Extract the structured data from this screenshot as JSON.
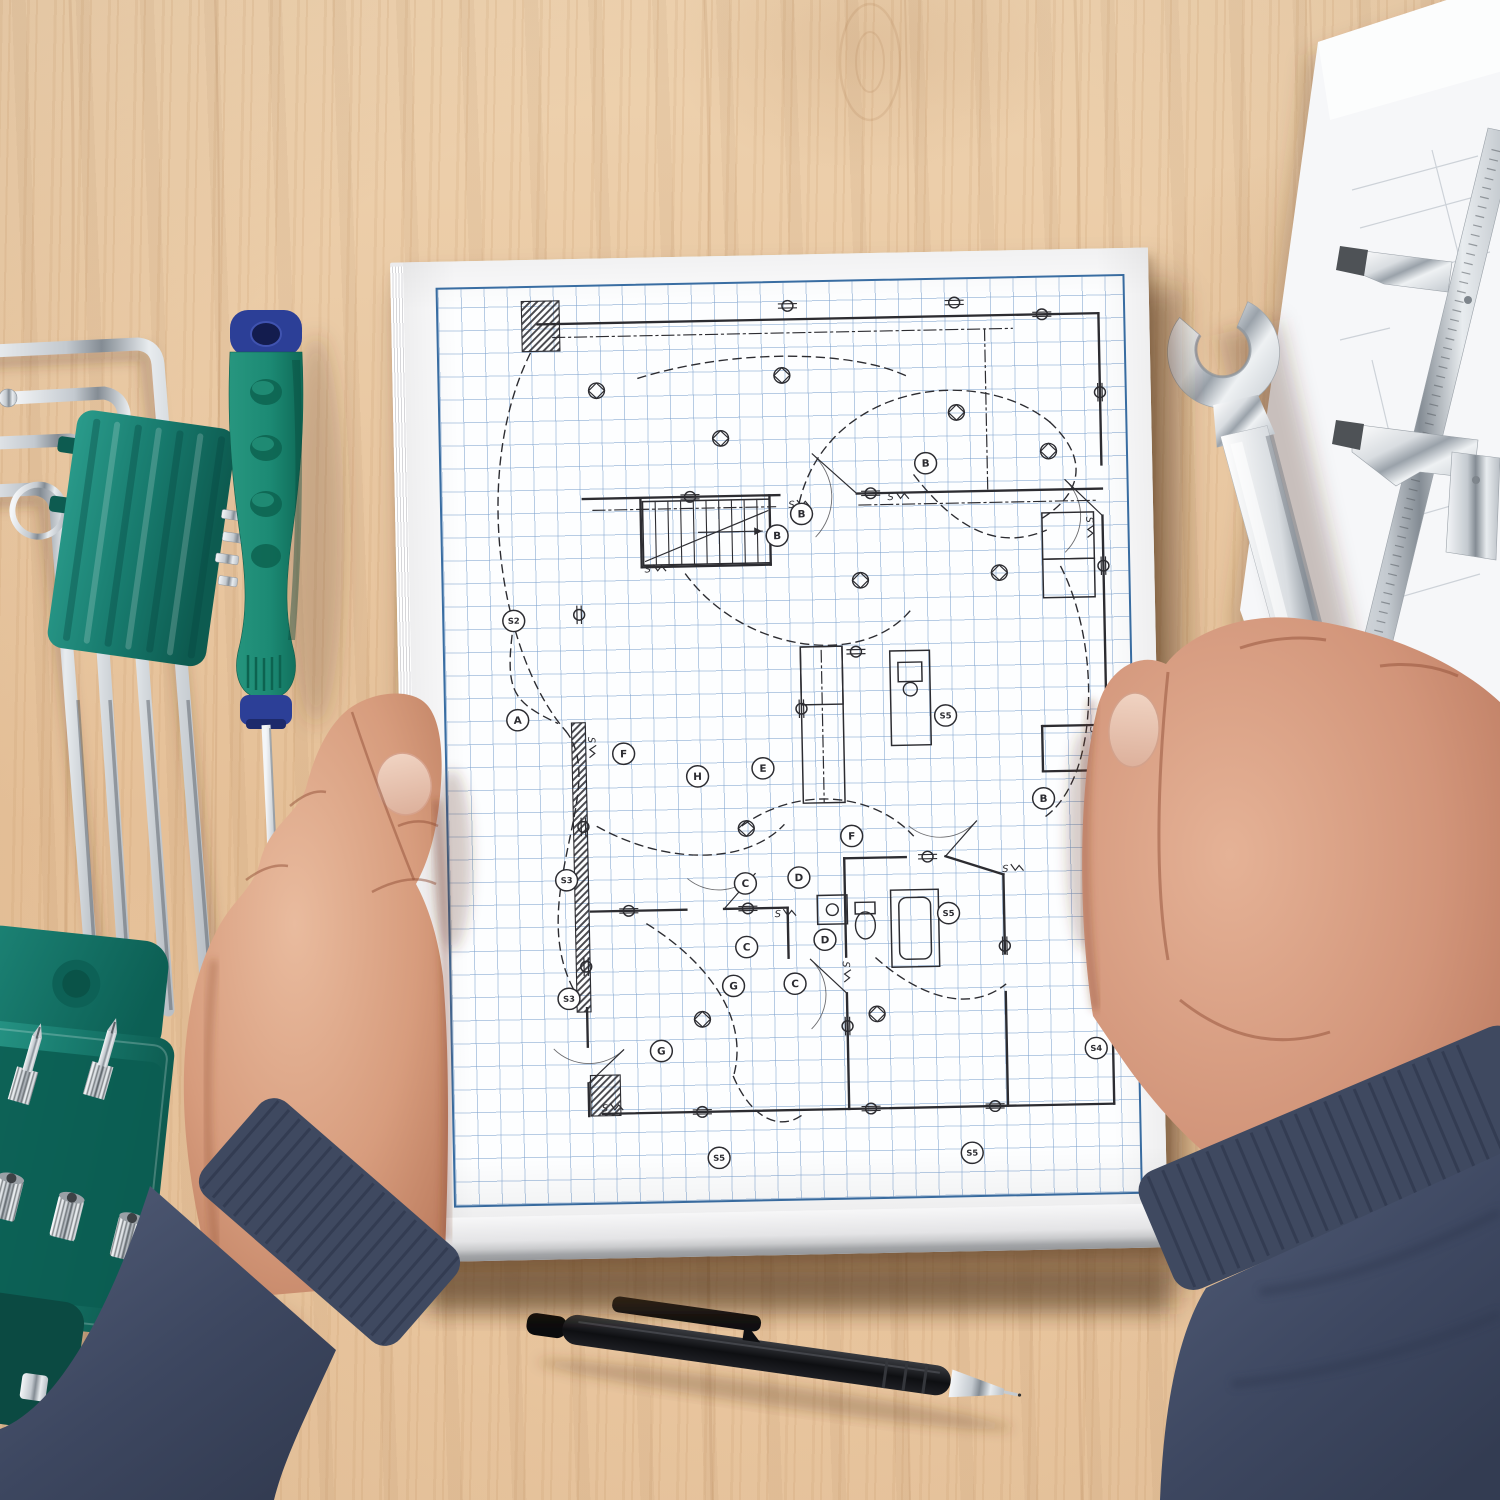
{
  "colors": {
    "wood": "#e7c6a1",
    "wood_grain": "#b98a58",
    "paper": "#fbfbfc",
    "grid_line": "#a9c4e0",
    "grid_border": "#3a6fa5",
    "ink": "#2c2c31",
    "teal": "#178073",
    "teal_dark": "#0c5c50",
    "handle_green": "#1c8a74",
    "handle_blue": "#2c3f97",
    "chrome": "#d6dadf",
    "chrome_dark": "#8e969e",
    "sweater": "#49536a",
    "sweater_dark": "#39435a",
    "skin": "#d8a084",
    "skin_shadow": "#b97f63",
    "nail": "#e8c4b0",
    "pen_black": "#17181a"
  },
  "wrench": {
    "stamp": "17"
  },
  "floor_plan": {
    "walls": [
      [
        100,
        38,
        665,
        38
      ],
      [
        665,
        38,
        665,
        195
      ],
      [
        665,
        248,
        665,
        465
      ],
      [
        665,
        512,
        665,
        858
      ],
      [
        150,
        858,
        665,
        858
      ],
      [
        136,
        748,
        136,
        788
      ],
      [
        136,
        826,
        136,
        860
      ],
      [
        142,
        220,
        340,
        220
      ],
      [
        418,
        220,
        665,
        220
      ],
      [
        200,
        222,
        200,
        292
      ],
      [
        200,
        292,
        330,
        292
      ],
      [
        330,
        220,
        330,
        292
      ],
      [
        398,
        598,
        398,
        700
      ],
      [
        398,
        738,
        398,
        858
      ],
      [
        558,
        618,
        558,
        700
      ],
      [
        558,
        740,
        558,
        858
      ],
      [
        142,
        648,
        238,
        648
      ],
      [
        276,
        648,
        340,
        648
      ],
      [
        340,
        648,
        340,
        700
      ],
      [
        398,
        598,
        460,
        598
      ],
      [
        500,
        598,
        558,
        618
      ],
      [
        600,
        465,
        665,
        465
      ],
      [
        600,
        465,
        600,
        512
      ],
      [
        600,
        512,
        665,
        512
      ]
    ],
    "hatches": [
      [
        84,
        14,
        38,
        52
      ],
      [
        126,
        452,
        14,
        300
      ],
      [
        138,
        818,
        30,
        42
      ]
    ],
    "dashdot": [
      [
        115,
        52,
        578,
        52
      ],
      [
        550,
        52,
        550,
        218
      ],
      [
        152,
        232,
        336,
        232
      ],
      [
        379,
        382,
        379,
        540
      ],
      [
        420,
        232,
        660,
        232
      ]
    ],
    "stairs": {
      "x": 202,
      "y": 224,
      "w": 128,
      "h": 66
    },
    "fixtures": {
      "rects": [
        [
          358,
          378,
          42,
          162
        ],
        [
          358,
          378,
          42,
          60
        ],
        [
          448,
          384,
          40,
          98
        ],
        [
          456,
          396,
          24,
          20
        ],
        [
          444,
          632,
          48,
          80
        ],
        [
          452,
          640,
          32,
          64,
          8
        ],
        [
          370,
          636,
          30,
          30
        ],
        [
          408,
          644,
          20,
          12
        ],
        [
          604,
          244,
          52,
          48
        ],
        [
          604,
          292,
          52,
          40
        ]
      ],
      "ellipses": [
        [
          418,
          668,
          10,
          14
        ],
        [
          385,
          651,
          6,
          6
        ],
        [
          468,
          424,
          7,
          7
        ]
      ]
    },
    "doors": [
      [
        418,
        220,
        374,
        178
      ],
      [
        276,
        648,
        308,
        612
      ],
      [
        665,
        248,
        628,
        210
      ],
      [
        136,
        826,
        172,
        792
      ],
      [
        500,
        598,
        532,
        562
      ],
      [
        398,
        738,
        362,
        702
      ]
    ],
    "arcs": [
      "M 92 68 C 30 190 55 380 120 460",
      "M 120 460 C 165 520 70 640 128 738",
      "M 360 228 C 390 108 540 86 614 150",
      "M 614 150 C 656 192 642 228 600 252",
      "M 200 96 C 300 66 420 72 472 100",
      "M 244 300 C 300 382 420 402 470 342",
      "M 296 562 C 356 520 430 532 468 576",
      "M 198 662 C 258 702 300 762 282 822",
      "M 428 702 C 470 742 520 762 558 732",
      "M 622 300 C 660 380 658 520 600 560",
      "M 476 202 C 518 260 560 282 608 262",
      "M 150 560 C 220 602 300 602 338 562",
      "M 282 822 C 300 868 330 880 352 862",
      "M 68 360 C 60 420 70 430 112 452"
    ],
    "outlets": [
      [
        352,
        24,
        0
      ],
      [
        520,
        24,
        0
      ],
      [
        608,
        38,
        0
      ],
      [
        665,
        120,
        90
      ],
      [
        665,
        300,
        90
      ],
      [
        665,
        560,
        90
      ],
      [
        665,
        700,
        90
      ],
      [
        250,
        858,
        0
      ],
      [
        420,
        858,
        0
      ],
      [
        545,
        858,
        0
      ],
      [
        136,
        340,
        90
      ],
      [
        136,
        560,
        90
      ],
      [
        136,
        705,
        90
      ],
      [
        250,
        220,
        0
      ],
      [
        432,
        220,
        0
      ],
      [
        180,
        648,
        0
      ],
      [
        300,
        648,
        0
      ],
      [
        482,
        598,
        0
      ],
      [
        398,
        772,
        90
      ],
      [
        558,
        692,
        90
      ],
      [
        358,
        442,
        90
      ],
      [
        414,
        384,
        0
      ]
    ],
    "lights": [
      [
        282,
        160
      ],
      [
        520,
        138
      ],
      [
        612,
        180
      ],
      [
        158,
        108
      ],
      [
        420,
        310
      ],
      [
        300,
        565
      ],
      [
        428,
        760
      ],
      [
        252,
        762
      ],
      [
        560,
        305
      ],
      [
        345,
        96
      ]
    ],
    "switches": [
      [
        352,
        230,
        0
      ],
      [
        652,
        252,
        90
      ],
      [
        146,
        470,
        90
      ],
      [
        330,
        654,
        0
      ],
      [
        398,
        708,
        90
      ],
      [
        652,
        470,
        90
      ],
      [
        206,
        294,
        0
      ],
      [
        452,
        224,
        0
      ],
      [
        560,
        612,
        0
      ],
      [
        152,
        852,
        0
      ]
    ],
    "labels": [
      [
        72,
        448,
        "A"
      ],
      [
        70,
        345,
        "S2"
      ],
      [
        362,
        240,
        "B"
      ],
      [
        337,
        262,
        "B"
      ],
      [
        488,
        190,
        "B"
      ],
      [
        600,
        540,
        "B"
      ],
      [
        318,
        503,
        "E"
      ],
      [
        252,
        510,
        "H"
      ],
      [
        178,
        485,
        "F"
      ],
      [
        406,
        575,
        "F"
      ],
      [
        298,
        622,
        "C"
      ],
      [
        298,
        688,
        "C"
      ],
      [
        346,
        727,
        "C"
      ],
      [
        352,
        617,
        "D"
      ],
      [
        377,
        682,
        "D"
      ],
      [
        284,
        728,
        "G"
      ],
      [
        210,
        794,
        "G"
      ],
      [
        118,
        615,
        "S3"
      ],
      [
        118,
        738,
        "S3"
      ],
      [
        503,
        452,
        "S5"
      ],
      [
        502,
        657,
        "S5"
      ],
      [
        266,
        906,
        "S5"
      ],
      [
        521,
        906,
        "S5"
      ],
      [
        648,
        800,
        "S4"
      ]
    ]
  }
}
